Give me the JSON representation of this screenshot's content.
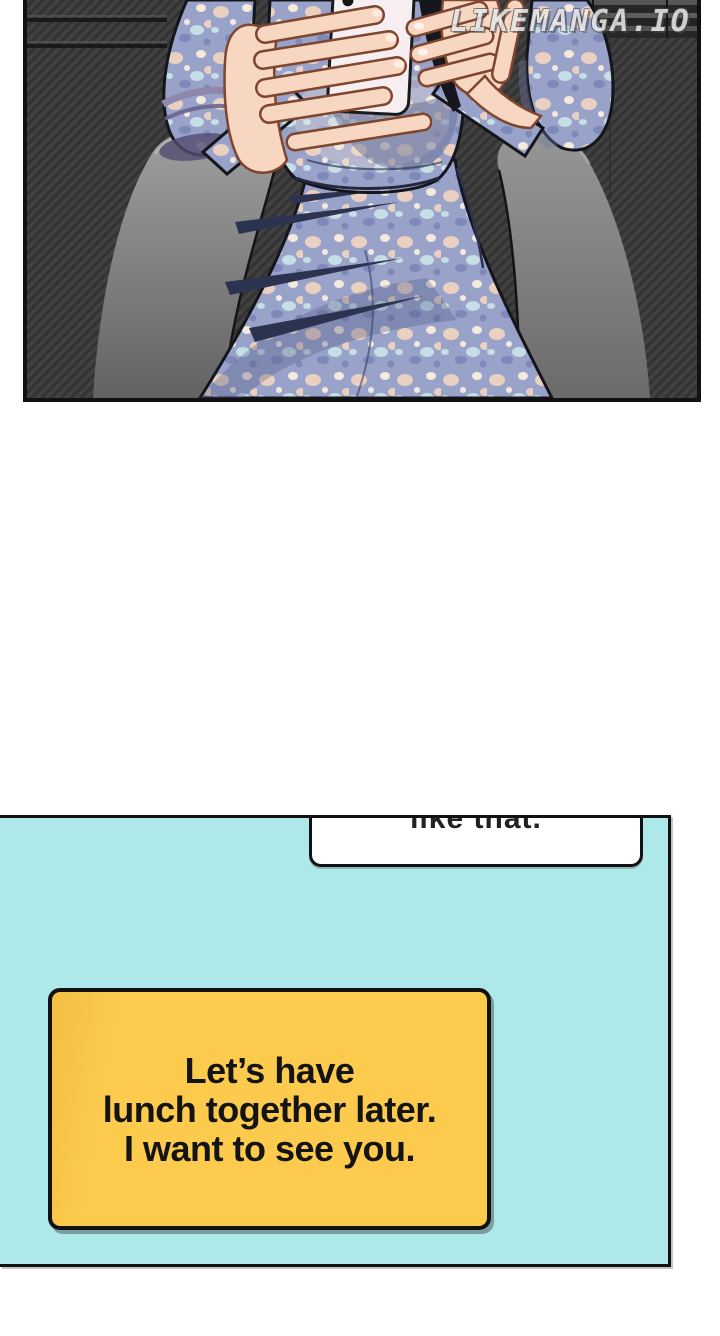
{
  "watermark": {
    "text": "LIKEMANGA.IO"
  },
  "art_panel": {
    "alt": "Woman in a blue floral dress seated in a gray armchair, holding a white phone with both hands"
  },
  "dialog_panel": {
    "speech_bubble": {
      "text": "like that."
    },
    "caption_box": {
      "lines": [
        "Let’s have",
        "lunch together later.",
        "I want to see you."
      ]
    }
  },
  "colors": {
    "ink-black": "#111111",
    "art-bg": "#3b3b3b",
    "panel-cyan": "#aee8e8",
    "bubble-white": "#ffffff",
    "caption-yellow": "#fccb4d",
    "watermark-gray": "#e6e6e6",
    "dress-base": "#99a2c9",
    "chair-gray": "#8f8f8f",
    "skin": "#f8d7c2"
  }
}
